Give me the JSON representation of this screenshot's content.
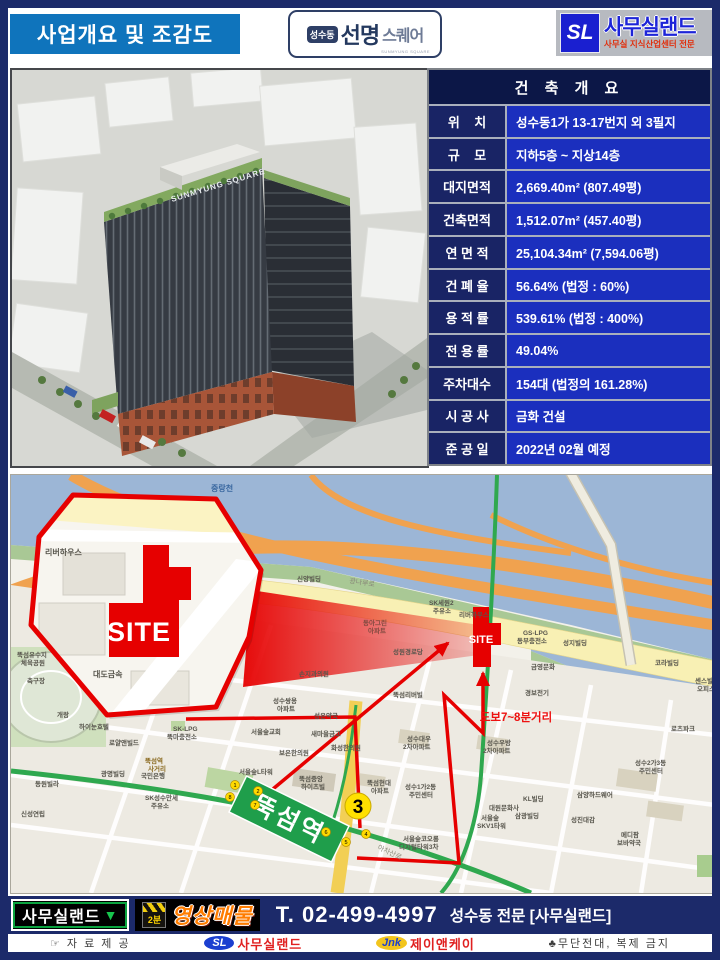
{
  "header": {
    "title": "사업개요 및 조감도",
    "logo_center": {
      "badge": "성수동",
      "name_bold": "선명",
      "name_light": "스퀘어",
      "sub": "SUNMYUNG SQUARE"
    },
    "logo_right": {
      "mark": "SL",
      "name": "사무실랜드",
      "sub": "사무실 지식산업센터 전문"
    }
  },
  "render": {
    "facade_logo": "SUNMYUNG SQUARE"
  },
  "table": {
    "title": "건 축 개 요",
    "rows": [
      {
        "label": "위    치",
        "value": "성수동1가 13-17번지 외 3필지"
      },
      {
        "label": "규    모",
        "value": "지하5층 ~ 지상14층"
      },
      {
        "label": "대지면적",
        "value": "2,669.40m² (807.49평)"
      },
      {
        "label": "건축면적",
        "value": "1,512.07m² (457.40평)"
      },
      {
        "label": "연 면 적",
        "value": "25,104.34m² (7,594.06평)"
      },
      {
        "label": "건 폐 율",
        "value": "56.64% (법정 : 60%)"
      },
      {
        "label": "용 적 률",
        "value": "539.61% (법정 : 400%)"
      },
      {
        "label": "전 용 률",
        "value": "49.04%"
      },
      {
        "label": "주차대수",
        "value": "154대 (법정의 161.28%)"
      },
      {
        "label": "시 공 사",
        "value": "금화 건설"
      },
      {
        "label": "준 공 일",
        "value": "2022년 02월 예정"
      }
    ]
  },
  "map": {
    "site_label": "SITE",
    "walk_label": "도보7~8분거리",
    "station": {
      "name": "뚝섬역",
      "exit_number": "3"
    },
    "road_labels": {
      "gwangnaru": "광나루로",
      "achasan": "아차산로"
    },
    "exits": [
      {
        "n": "1",
        "x": 224,
        "y": 310
      },
      {
        "n": "2",
        "x": 247,
        "y": 316
      },
      {
        "n": "8",
        "x": 219,
        "y": 322
      },
      {
        "n": "7",
        "x": 244,
        "y": 330
      },
      {
        "n": "6",
        "x": 315,
        "y": 357
      },
      {
        "n": "5",
        "x": 335,
        "y": 367
      },
      {
        "n": "4",
        "x": 355,
        "y": 359
      }
    ],
    "labels": [
      {
        "t": "중랑천",
        "x": 200,
        "y": 10,
        "c": "#39679f",
        "s": 8
      },
      {
        "t": "신양빌딩",
        "x": 286,
        "y": 102
      },
      {
        "t": "SK세원2",
        "x": 418,
        "y": 126
      },
      {
        "t": "주유소",
        "x": 422,
        "y": 134
      },
      {
        "t": "리버하우스",
        "x": 448,
        "y": 138
      },
      {
        "t": "GS-LPG",
        "x": 512,
        "y": 156
      },
      {
        "t": "동부충전소",
        "x": 506,
        "y": 164
      },
      {
        "t": "성지빌딩",
        "x": 552,
        "y": 166
      },
      {
        "t": "코라빌딩",
        "x": 644,
        "y": 186
      },
      {
        "t": "금영문화",
        "x": 520,
        "y": 190
      },
      {
        "t": "경보전기",
        "x": 514,
        "y": 216
      },
      {
        "t": "성원경로당",
        "x": 382,
        "y": 175
      },
      {
        "t": "동아그린",
        "x": 352,
        "y": 146,
        "c": "#824a40"
      },
      {
        "t": "아파트",
        "x": 357,
        "y": 154,
        "c": "#824a40"
      },
      {
        "t": "손지과의원",
        "x": 288,
        "y": 197
      },
      {
        "t": "뚝섬리버빌",
        "x": 382,
        "y": 218
      },
      {
        "t": "성수쌍용",
        "x": 262,
        "y": 224
      },
      {
        "t": "아파트",
        "x": 266,
        "y": 232
      },
      {
        "t": "성은약국",
        "x": 303,
        "y": 239
      },
      {
        "t": "서울숲교회",
        "x": 240,
        "y": 255
      },
      {
        "t": "새마을금고",
        "x": 300,
        "y": 257
      },
      {
        "t": "보은한의원",
        "x": 268,
        "y": 276
      },
      {
        "t": "화성한의원",
        "x": 320,
        "y": 271
      },
      {
        "t": "성수대우",
        "x": 396,
        "y": 262
      },
      {
        "t": "2차아파트",
        "x": 392,
        "y": 270
      },
      {
        "t": "성수우방",
        "x": 476,
        "y": 266
      },
      {
        "t": "2차아파트",
        "x": 472,
        "y": 274
      },
      {
        "t": "서울숲L타워",
        "x": 228,
        "y": 295
      },
      {
        "t": "뚝섬중앙",
        "x": 288,
        "y": 302
      },
      {
        "t": "하이츠빌",
        "x": 290,
        "y": 310
      },
      {
        "t": "뚝섬현대",
        "x": 356,
        "y": 306
      },
      {
        "t": "아파트",
        "x": 360,
        "y": 314
      },
      {
        "t": "성수1가2동",
        "x": 394,
        "y": 310
      },
      {
        "t": "주민센터",
        "x": 398,
        "y": 318
      },
      {
        "t": "KL빌딩",
        "x": 512,
        "y": 322
      },
      {
        "t": "대원문화사",
        "x": 478,
        "y": 331
      },
      {
        "t": "서울숲",
        "x": 470,
        "y": 341
      },
      {
        "t": "SKV1타워",
        "x": 466,
        "y": 349
      },
      {
        "t": "삼광빌딩",
        "x": 504,
        "y": 339
      },
      {
        "t": "성수2가3동",
        "x": 624,
        "y": 286
      },
      {
        "t": "주민센터",
        "x": 628,
        "y": 294
      },
      {
        "t": "로츠파크",
        "x": 660,
        "y": 252
      },
      {
        "t": "센스빌",
        "x": 684,
        "y": 204
      },
      {
        "t": "오피스",
        "x": 686,
        "y": 212
      },
      {
        "t": "삼양하드웨어",
        "x": 566,
        "y": 318
      },
      {
        "t": "성진대감",
        "x": 560,
        "y": 343
      },
      {
        "t": "메디팜",
        "x": 610,
        "y": 358
      },
      {
        "t": "보바약국",
        "x": 606,
        "y": 366
      },
      {
        "t": "서울숲코오롱",
        "x": 392,
        "y": 362
      },
      {
        "t": "디지털타워3차",
        "x": 388,
        "y": 370
      },
      {
        "t": "뚝섬유수지",
        "x": 6,
        "y": 178
      },
      {
        "t": "체육공원",
        "x": 10,
        "y": 186
      },
      {
        "t": "축구장",
        "x": 16,
        "y": 204
      },
      {
        "t": "개랑",
        "x": 46,
        "y": 238
      },
      {
        "t": "하이눈호텔",
        "x": 68,
        "y": 250
      },
      {
        "t": "로얄앤빌드",
        "x": 98,
        "y": 266
      },
      {
        "t": "SK-LPG",
        "x": 162,
        "y": 252
      },
      {
        "t": "뚝마충전소",
        "x": 156,
        "y": 260
      },
      {
        "t": "뚝섬역",
        "x": 134,
        "y": 284,
        "c": "#8a6a20"
      },
      {
        "t": "사거리",
        "x": 137,
        "y": 292,
        "c": "#8a6a20"
      },
      {
        "t": "광명빌딩",
        "x": 90,
        "y": 297
      },
      {
        "t": "국민은행",
        "x": 130,
        "y": 299
      },
      {
        "t": "동원빌라",
        "x": 24,
        "y": 307
      },
      {
        "t": "신성연립",
        "x": 10,
        "y": 337
      },
      {
        "t": "SK성수만세",
        "x": 134,
        "y": 321
      },
      {
        "t": "주유소",
        "x": 140,
        "y": 329
      },
      {
        "t": "리버하우스",
        "x": 34,
        "y": 74,
        "s": 8
      },
      {
        "t": "대도금속",
        "x": 82,
        "y": 196,
        "s": 8
      }
    ]
  },
  "footer": {
    "brand_box": "사무실랜드",
    "brand_arrow": "▼",
    "clapper": "2분",
    "video_label": "영상매물",
    "phone": "T. 02-499-4997",
    "tagline": "성수동 전문 [사무실랜드]"
  },
  "bottom": {
    "left": "☞ 자 료 제 공",
    "sl_mark": "SL",
    "sl_name": "사무실랜드",
    "jnk_mark": "Jnk",
    "jnk_name": "제이앤케이",
    "right": "♣무단전대, 복제 금지"
  },
  "colors": {
    "navy": "#1c2a6a",
    "title_blue": "#0f74bc",
    "table_value_blue": "#1b2fbe",
    "table_label_navy": "#192465",
    "red": "#e60000",
    "station_green": "#1f9e4b"
  }
}
